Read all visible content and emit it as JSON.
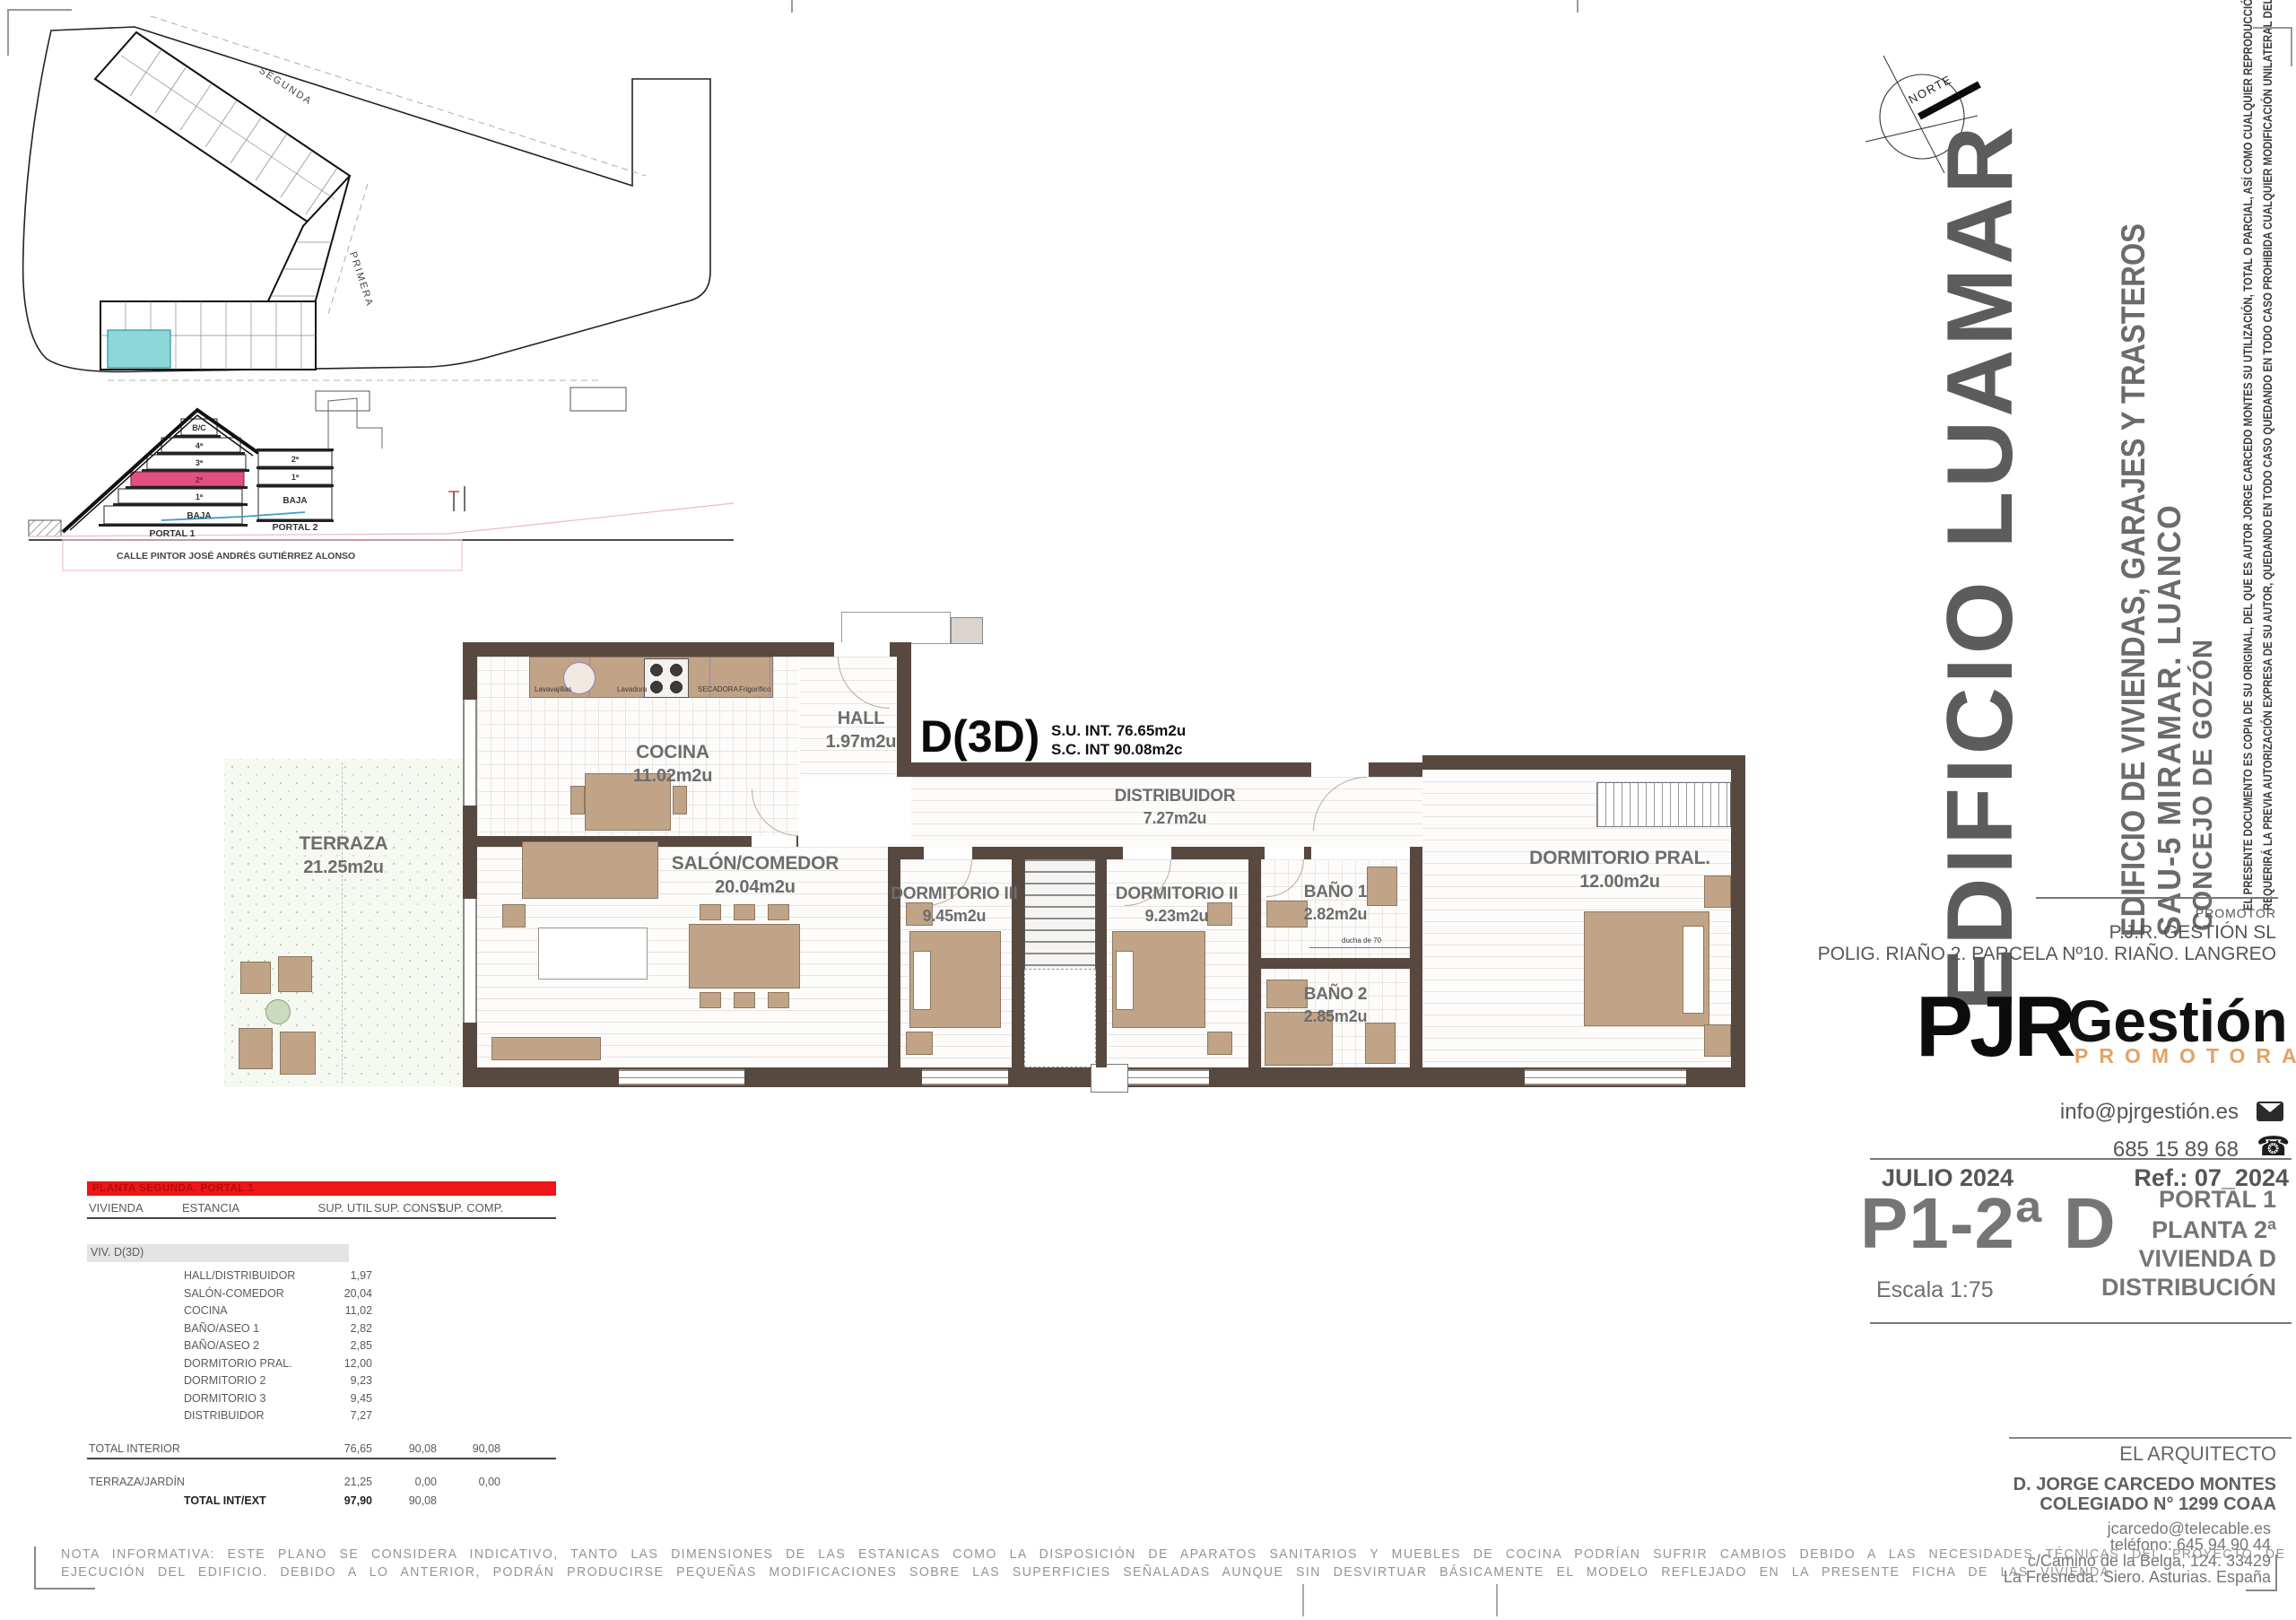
{
  "site": {
    "segunda": "SEGUNDA",
    "primera": "PRIMERA"
  },
  "section": {
    "bc": "B/C",
    "p4": "4ª",
    "p3": "3ª",
    "p2": "2ª",
    "p1": "1ª",
    "baja_l": "BAJA",
    "r2": "2ª",
    "r1": "1ª",
    "baja_r": "BAJA",
    "portal1": "PORTAL 1",
    "portal2": "PORTAL 2",
    "street": "CALLE PINTOR JOSÉ ANDRÉS GUTIÉRREZ ALONSO"
  },
  "north": {
    "label": "NORTE"
  },
  "plan": {
    "unit": {
      "code": "D(3D)",
      "su": "S.U. INT. 76.65m2u",
      "sc": "S.C. INT  90.08m2c"
    },
    "rooms": {
      "terraza": {
        "name": "TERRAZA",
        "area": "21.25m2u"
      },
      "cocina": {
        "name": "COCINA",
        "area": "11.02m2u"
      },
      "hall": {
        "name": "HALL",
        "area": "1.97m2u"
      },
      "salon": {
        "name": "SALÓN/COMEDOR",
        "area": "20.04m2u"
      },
      "distribuidor": {
        "name": "DISTRIBUIDOR",
        "area": "7.27m2u"
      },
      "dorm3": {
        "name": "DORMITORIO III",
        "area": "9.45m2u"
      },
      "dorm2": {
        "name": "DORMITORIO II",
        "area": "9.23m2u"
      },
      "bano1": {
        "name": "BAÑO 1",
        "area": "2.82m2u"
      },
      "bano2": {
        "name": "BAÑO 2",
        "area": "2.85m2u"
      },
      "dormpral": {
        "name": "DORMITORIO PRAL.",
        "area": "12.00m2u"
      }
    },
    "appliances": {
      "a1": "Lavavajillas",
      "a2": "Lavadora",
      "a3": "SECADORA",
      "a4": "Frigorífico"
    },
    "ducha": "ducha de 70"
  },
  "table": {
    "band": "PLANTA SEGUNDA. PORTAL 1",
    "cols": {
      "vivienda": "VIVIENDA",
      "estancia": "ESTANCIA",
      "util": "SUP. UTIL",
      "const": "SUP. CONST.",
      "comp": "SUP. COMP."
    },
    "viv": "VIV. D(3D)",
    "rows": [
      {
        "estancia": "HALL/DISTRIBUIDOR",
        "util": "1,97"
      },
      {
        "estancia": "SALÓN-COMEDOR",
        "util": "20,04"
      },
      {
        "estancia": "COCINA",
        "util": "11,02"
      },
      {
        "estancia": "BAÑO/ASEO 1",
        "util": "2,82"
      },
      {
        "estancia": "BAÑO/ASEO 2",
        "util": "2,85"
      },
      {
        "estancia": "DORMITORIO PRAL.",
        "util": "12,00"
      },
      {
        "estancia": "DORMITORIO 2",
        "util": "9,23"
      },
      {
        "estancia": "DORMITORIO 3",
        "util": "9,45"
      },
      {
        "estancia": "DISTRIBUIDOR",
        "util": "7,27"
      }
    ],
    "totals": {
      "interior_label": "TOTAL INTERIOR",
      "interior_util": "76,65",
      "interior_const": "90,08",
      "interior_comp": "90,08",
      "terraza_label": "TERRAZA/JARDÍN",
      "terraza_util": "21,25",
      "terraza_const": "0,00",
      "terraza_comp": "0,00",
      "total_label": "TOTAL INT/EXT",
      "total_util": "97,90",
      "total_const": "90,08"
    }
  },
  "tb": {
    "project": "EDIFICIO LUAMAR",
    "subtitle": "EDIFICIO DE VIVIENDAS, GARAJES Y TRASTEROS",
    "location": "SAU-5 MIRAMAR. LUANCO",
    "municipality": "CONCEJO DE GOZÓN",
    "disclaimer1": "EL PRESENTE DOCUMENTO ES COPIA DE SU ORIGINAL, DEL QUE ES AUTOR  JORGE CARCEDO MONTES SU UTILIZACIÓN, TOTAL O PARCIAL, ASÍ COMO CUALQUIER REPRODUCCIÓN O CESIÓN A TERCEROS,",
    "disclaimer2": "REQUERIRÁ LA PREVIA AUTORIZACIÓN EXPRESA DE SU AUTOR, QUEDANDO EN TODO CASO QUEDANDO EN TODO CASO PROHIBIDA CUALQUIER MODIFICACIÓN UNILATERAL DEL  MISMO.",
    "promotor_label": "PROMOTOR",
    "promotor_name": "P.J.R. GESTIÓN SL",
    "promotor_addr": "POLIG. RIAÑO 2. PARCELA Nº10. RIAÑO. LANGREO",
    "logo_pjr": "PJR",
    "logo_gestion": "Gestión",
    "logo_promotora": "PROMOTORA",
    "email": "info@pjrgestión.es",
    "phone": "685 15 89 68",
    "date": "JULIO 2024",
    "ref": "Ref.: 07_2024",
    "code": "P1-2ª D",
    "portal": "PORTAL 1",
    "planta": "PLANTA 2ª",
    "vivienda": "VIVIENDA D",
    "tipo": "DISTRIBUCIÓN",
    "escala": "Escala  1:75",
    "arquitecto_label": "EL ARQUITECTO",
    "arquitecto": "D. JORGE CARCEDO MONTES",
    "colegiado": "COLEGIADO N° 1299 COAA",
    "arch_email": "jcarcedo@telecable.es",
    "arch_phone": "teléfono: 645 94 90 44",
    "arch_addr1": "c/Camino de la Belga, 124. 33429",
    "arch_addr2": "La Fresneda. Siero. Asturias. España"
  },
  "nota": {
    "l1": "NOTA INFORMATIVA: ESTE PLANO SE CONSIDERA INDICATIVO, TANTO LAS DIMENSIONES DE LAS ESTANICAS COMO LA DISPOSICIÓN DE APARATOS SANITARIOS Y MUEBLES DE COCINA PODRÍAN SUFRIR CAMBIOS DEBIDO A LAS NECESIDADES TÉCNICAS DEL PROYECTO DE",
    "l2": "EJECUCIÓN DEL EDIFICIO. DEBIDO A LO ANTERIOR, PODRÁN PRODUCIRSE PEQUEÑAS MODIFICACIONES SOBRE LAS SUPERFICIES SEÑALADAS AUNQUE SIN DESVIRTUAR BÁSICAMENTE EL MODELO REFLEJADO EN LA PRESENTE FICHA DE LAS VIVIENDA"
  },
  "colors": {
    "wall": "#574840",
    "furniture": "#c1a487",
    "section_highlight": "#e2517d",
    "unit_highlight_cyan": "#8ed7d8",
    "table_band_red": "#ee1616",
    "promotora_orange": "#e2a266"
  }
}
